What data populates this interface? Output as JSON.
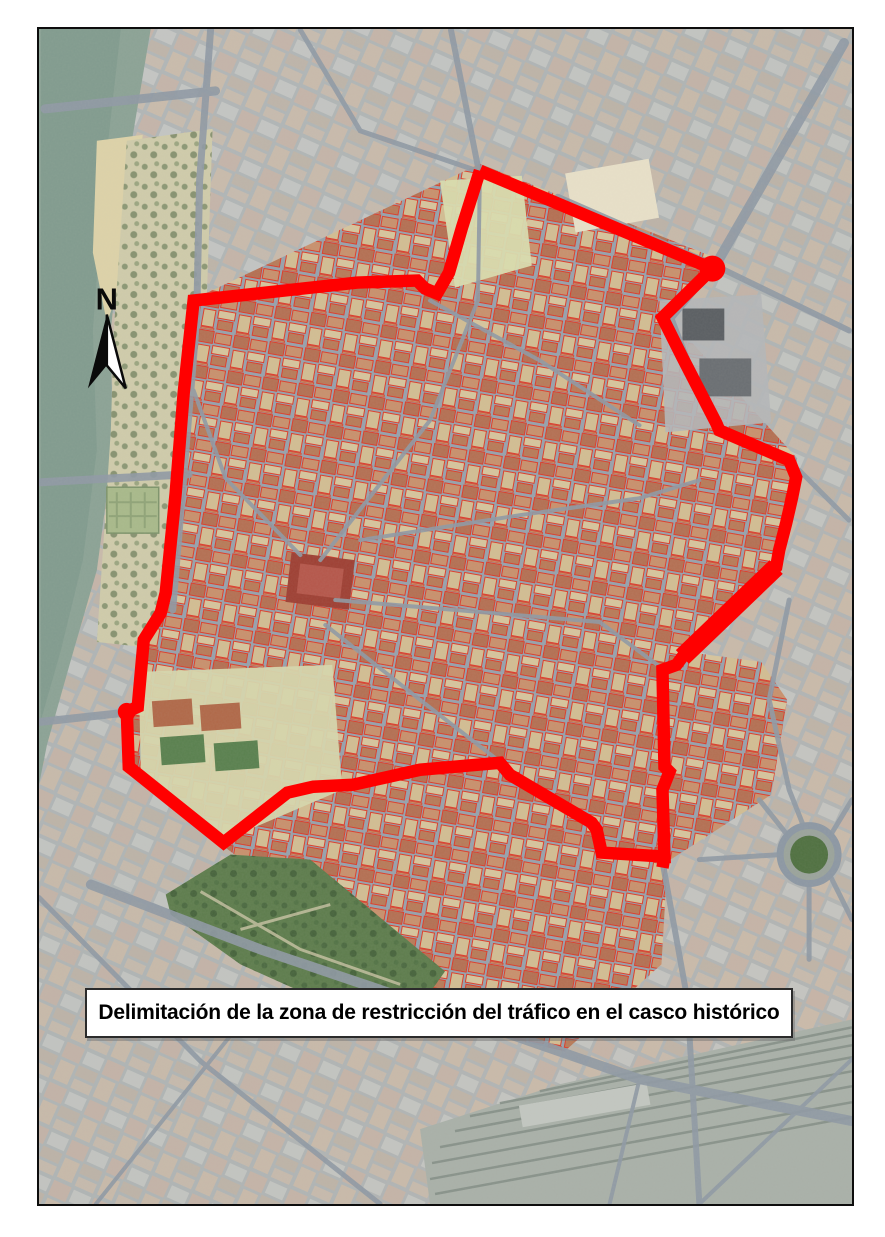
{
  "map": {
    "title_box": {
      "text": "Delimitación de la zona de restricción del tráfico en el casco histórico"
    },
    "north_arrow": {
      "label": "N"
    },
    "boundary": {
      "label": "zona de restricción del tráfico",
      "color": "#ff0000",
      "stroke_width": 12.5,
      "points": [
        [
          480,
          170
        ],
        [
          462,
          227
        ],
        [
          449,
          272
        ],
        [
          437,
          293
        ],
        [
          425,
          288
        ],
        [
          417,
          280
        ],
        [
          357,
          282
        ],
        [
          193,
          300
        ],
        [
          183,
          393
        ],
        [
          175,
          493
        ],
        [
          165,
          593
        ],
        [
          160,
          613
        ],
        [
          143,
          640
        ],
        [
          137,
          707
        ],
        [
          126,
          712
        ],
        [
          128,
          767
        ],
        [
          223,
          843
        ],
        [
          287,
          793
        ],
        [
          313,
          787
        ],
        [
          353,
          785
        ],
        [
          420,
          770
        ],
        [
          500,
          763
        ],
        [
          510,
          775
        ],
        [
          592,
          823
        ],
        [
          597,
          830
        ],
        [
          602,
          853
        ],
        [
          665,
          857
        ],
        [
          663,
          790
        ],
        [
          670,
          772
        ],
        [
          665,
          767
        ],
        [
          663,
          670
        ],
        [
          677,
          665
        ],
        [
          683,
          657
        ],
        [
          777,
          567
        ],
        [
          780,
          550
        ],
        [
          787,
          523
        ],
        [
          793,
          497
        ],
        [
          797,
          477
        ],
        [
          790,
          460
        ],
        [
          720,
          430
        ],
        [
          717,
          423
        ],
        [
          683,
          357
        ],
        [
          663,
          317
        ],
        [
          713,
          268
        ],
        [
          480,
          170
        ]
      ],
      "tail": [
        [
          665,
          857
        ],
        [
          663,
          868
        ]
      ],
      "thick_segments": [
        {
          "points": [
            [
              777,
              567
            ],
            [
              683,
              657
            ]
          ],
          "width": 19
        }
      ],
      "thick_nodes": [
        [
          713,
          268,
          13
        ],
        [
          126,
          712,
          9
        ]
      ]
    },
    "palette": {
      "boundary_red": "#ff0000",
      "frame_black": "#0d0d0d",
      "river_green": "#8ba295",
      "park_green": "#5d7c4c",
      "roof_red": "#b46f52",
      "street_gray": "#97a1ab",
      "sand_tan": "#ddd2a8"
    }
  }
}
